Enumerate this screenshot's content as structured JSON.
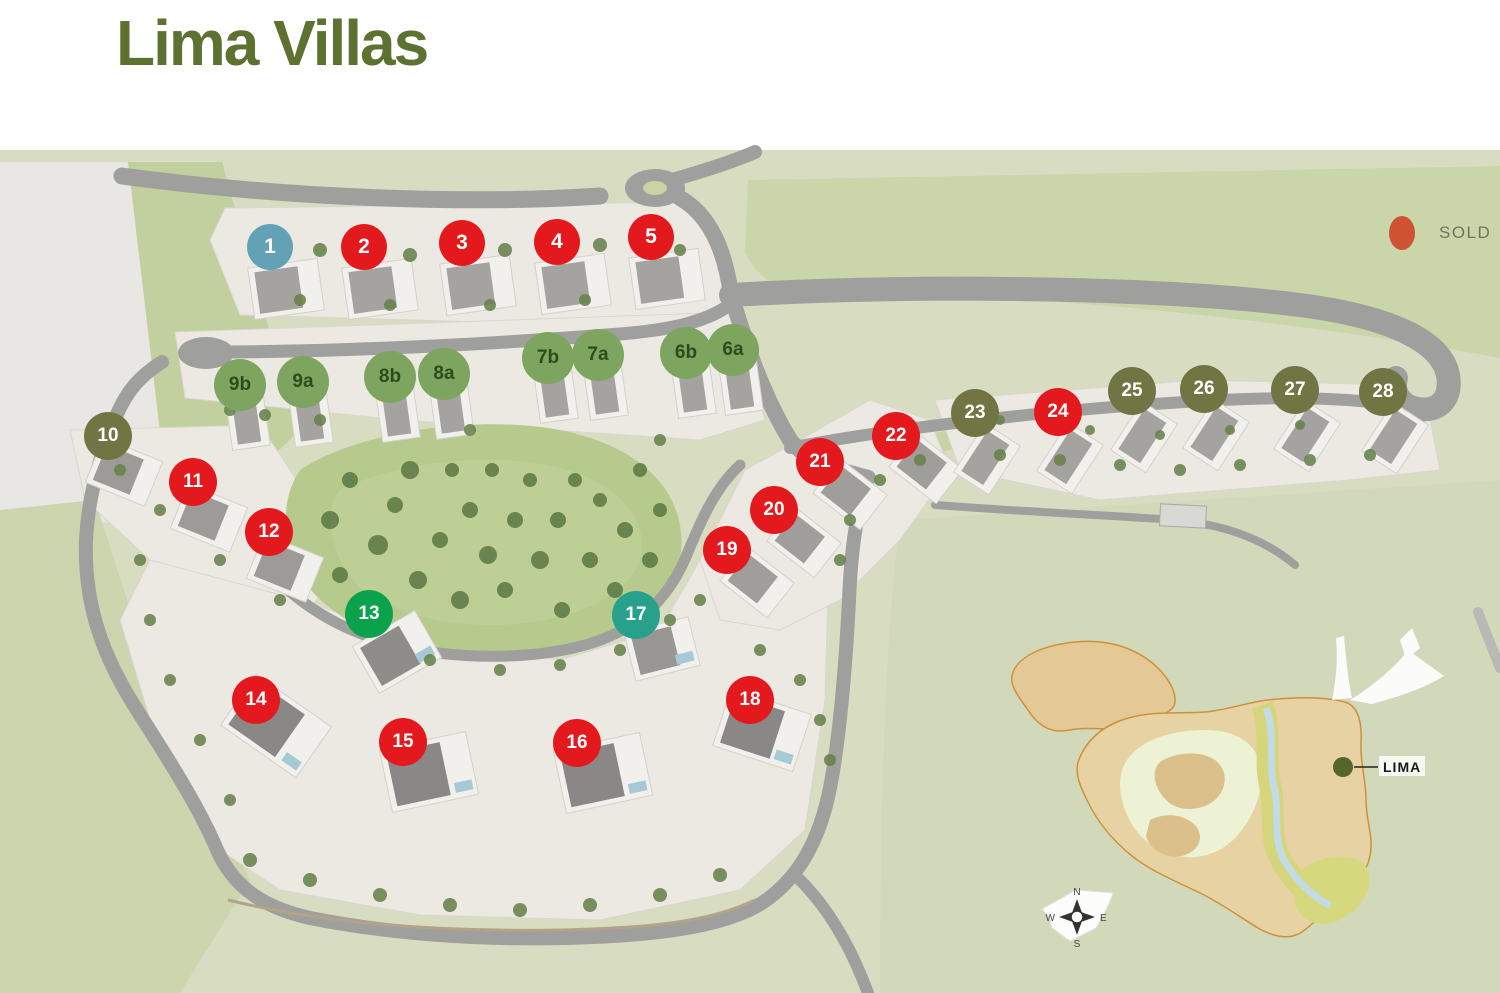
{
  "title": "Lima Villas",
  "legend": {
    "sold_label": "SOLD"
  },
  "colors": {
    "title_color": "#5d7130",
    "sold_dot": "#cf5233",
    "red": "#e4191d",
    "blue": "#62a1b6",
    "sage": "#7da55f",
    "olive": "#707543",
    "emerald": "#0ba24d",
    "teal": "#27a18c",
    "marker_text_light": "#ffffff",
    "marker_text_dark": "#2e4b1d"
  },
  "markers": [
    {
      "label": "1",
      "x": 270,
      "y": 247,
      "color": "blue",
      "text": "light",
      "sold": false
    },
    {
      "label": "2",
      "x": 364,
      "y": 247,
      "color": "red",
      "text": "light",
      "sold": true
    },
    {
      "label": "3",
      "x": 462,
      "y": 243,
      "color": "red",
      "text": "light",
      "sold": true
    },
    {
      "label": "4",
      "x": 557,
      "y": 242,
      "color": "red",
      "text": "light",
      "sold": true
    },
    {
      "label": "5",
      "x": 651,
      "y": 237,
      "color": "red",
      "text": "light",
      "sold": true
    },
    {
      "label": "6a",
      "x": 733,
      "y": 350,
      "color": "sage",
      "text": "dark",
      "sold": false
    },
    {
      "label": "6b",
      "x": 686,
      "y": 353,
      "color": "sage",
      "text": "dark",
      "sold": false
    },
    {
      "label": "7a",
      "x": 598,
      "y": 355,
      "color": "sage",
      "text": "dark",
      "sold": false
    },
    {
      "label": "7b",
      "x": 548,
      "y": 358,
      "color": "sage",
      "text": "dark",
      "sold": false
    },
    {
      "label": "8a",
      "x": 444,
      "y": 374,
      "color": "sage",
      "text": "dark",
      "sold": false
    },
    {
      "label": "8b",
      "x": 390,
      "y": 377,
      "color": "sage",
      "text": "dark",
      "sold": false
    },
    {
      "label": "9a",
      "x": 303,
      "y": 382,
      "color": "sage",
      "text": "dark",
      "sold": false
    },
    {
      "label": "9b",
      "x": 240,
      "y": 385,
      "color": "sage",
      "text": "dark",
      "sold": false
    },
    {
      "label": "10",
      "x": 108,
      "y": 436,
      "color": "olive",
      "text": "light",
      "sold": false
    },
    {
      "label": "11",
      "x": 193,
      "y": 482,
      "color": "red",
      "text": "light",
      "sold": true
    },
    {
      "label": "12",
      "x": 269,
      "y": 532,
      "color": "red",
      "text": "light",
      "sold": true
    },
    {
      "label": "13",
      "x": 369,
      "y": 614,
      "color": "emerald",
      "text": "light",
      "sold": false
    },
    {
      "label": "14",
      "x": 256,
      "y": 700,
      "color": "red",
      "text": "light",
      "sold": true
    },
    {
      "label": "15",
      "x": 403,
      "y": 742,
      "color": "red",
      "text": "light",
      "sold": true
    },
    {
      "label": "16",
      "x": 577,
      "y": 743,
      "color": "red",
      "text": "light",
      "sold": true
    },
    {
      "label": "17",
      "x": 636,
      "y": 615,
      "color": "teal",
      "text": "light",
      "sold": false
    },
    {
      "label": "18",
      "x": 750,
      "y": 700,
      "color": "red",
      "text": "light",
      "sold": true
    },
    {
      "label": "19",
      "x": 727,
      "y": 550,
      "color": "red",
      "text": "light",
      "sold": true
    },
    {
      "label": "20",
      "x": 774,
      "y": 510,
      "color": "red",
      "text": "light",
      "sold": true
    },
    {
      "label": "21",
      "x": 820,
      "y": 462,
      "color": "red",
      "text": "light",
      "sold": true
    },
    {
      "label": "22",
      "x": 896,
      "y": 436,
      "color": "red",
      "text": "light",
      "sold": true
    },
    {
      "label": "23",
      "x": 975,
      "y": 413,
      "color": "olive",
      "text": "light",
      "sold": false
    },
    {
      "label": "24",
      "x": 1058,
      "y": 412,
      "color": "red",
      "text": "light",
      "sold": true
    },
    {
      "label": "25",
      "x": 1132,
      "y": 391,
      "color": "olive",
      "text": "light",
      "sold": false
    },
    {
      "label": "26",
      "x": 1204,
      "y": 389,
      "color": "olive",
      "text": "light",
      "sold": false
    },
    {
      "label": "27",
      "x": 1295,
      "y": 390,
      "color": "olive",
      "text": "light",
      "sold": false
    },
    {
      "label": "28",
      "x": 1383,
      "y": 392,
      "color": "olive",
      "text": "light",
      "sold": false
    }
  ],
  "inset": {
    "location_label": "LIMA",
    "compass": {
      "north": "N",
      "east": "E",
      "south": "S",
      "west": "W"
    }
  }
}
